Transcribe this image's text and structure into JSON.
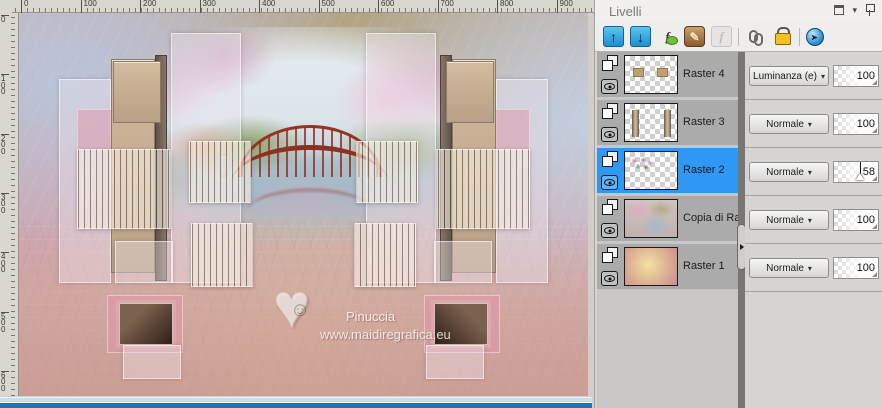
{
  "panel": {
    "title": "Livelli",
    "window_icons": [
      "restore-icon",
      "caret-down-icon",
      "pin-icon"
    ],
    "toolbar": {
      "items": [
        "move-layer-up",
        "move-layer-down",
        "new-adjustment-layer",
        "edit-layer",
        "disabled-tool",
        "link-layers",
        "lock-layer",
        "update-view"
      ]
    },
    "layers": [
      {
        "name": "Raster 4",
        "blend": "Luminanza (e)",
        "opacity": "100",
        "selected": false,
        "slider": false
      },
      {
        "name": "Raster 3",
        "blend": "Normale",
        "opacity": "100",
        "selected": false,
        "slider": false
      },
      {
        "name": "Raster 2",
        "blend": "Normale",
        "opacity": "58",
        "selected": true,
        "slider": true
      },
      {
        "name": "Copia di Raster 2",
        "blend": "Normale",
        "opacity": "100",
        "selected": false,
        "slider": false
      },
      {
        "name": "Raster 1",
        "blend": "Normale",
        "opacity": "100",
        "selected": false,
        "slider": false
      }
    ]
  },
  "canvas": {
    "watermark_name": "Pinuccia",
    "watermark_url": "www.maidiregrafica.eu",
    "watermark_heart": "♥",
    "watermark_face": "☺",
    "ruler_h_labels": [
      "0",
      "100",
      "200",
      "300",
      "400",
      "500",
      "600",
      "700",
      "800",
      "900"
    ],
    "ruler_v_labels": [
      "0",
      "100",
      "200",
      "300",
      "400",
      "500",
      "600"
    ]
  },
  "glyphs": {
    "up_arrow": "↑",
    "down_arrow": "↓",
    "fx": "f",
    "pencil": "✎",
    "caret": "▾"
  },
  "colors": {
    "selected_row": "#2f97f4",
    "row_gray": "#ababab",
    "taskbar_blue": "#2273ae",
    "scrollbar_blue": "#bfe0f2",
    "toolbar_button_blue": "#1d8fd0",
    "lock_yellow": "#f2c21e"
  }
}
